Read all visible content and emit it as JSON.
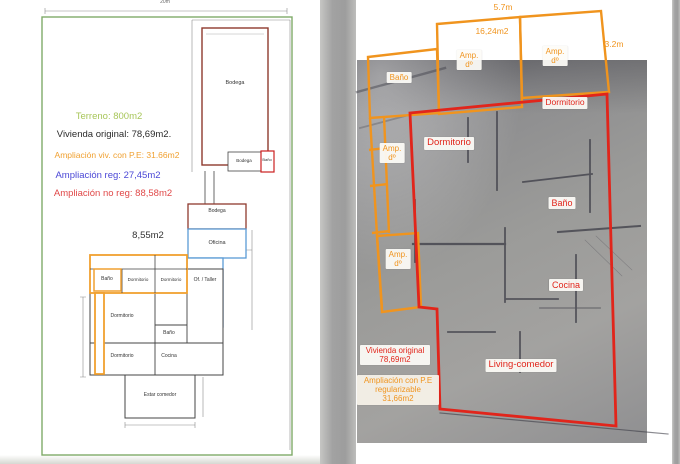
{
  "document": {
    "left_page": {
      "top_dimension": "20m",
      "legend": {
        "terreno": "Terreno: 800m2",
        "vivienda_original": "Vivienda original: 78,69m2.",
        "ampliacion_pe": "Ampliación viv. con P.E: 31.66m2",
        "ampliacion_reg": "Ampliación reg: 27,45m2",
        "ampliacion_no_reg": "Ampliación no reg: 88,58m2"
      },
      "area_note": "8,55m2",
      "rooms": {
        "bodega_big": "Bodega",
        "bodega_small": "Bodega",
        "bano_small": "Baño",
        "bodega_mid": "Bodega",
        "oficina": "Oficina",
        "of_taller": "Of. / Taller",
        "bano_top": "Baño",
        "dormitorio_top_1": "Dormitorio",
        "dormitorio_top_2": "Dormitorio",
        "dormitorio_mid": "Dormitorio",
        "dormitorio_bottom": "Dormitorio",
        "bano_right": "Baño",
        "cocina": "Cocina",
        "estar_comedor": "Estar comedor"
      }
    },
    "right_page": {
      "dimensions": {
        "top_width": "5.7m",
        "area": "16,24m2",
        "right_side": "3.2m"
      },
      "orange_labels": {
        "bano": "Baño",
        "amp_d": "Amp.\ndº"
      },
      "red_labels": {
        "dormitorio_top": "Dormitorio",
        "dormitorio_left": "Dormitorio",
        "bano": "Baño",
        "cocina": "Cocina",
        "living_comedor": "Living-comedor"
      },
      "summary": {
        "vivienda": "Vivienda original\n78,69m2",
        "ampliacion": "Ampliación con P.E\nregularizable\n31,66m2"
      }
    },
    "colors": {
      "site_green": "#7fab69",
      "annotation_orange": "#f0941e",
      "annotation_red": "#e1251b",
      "room_blue": "#5b9bd5",
      "bodega_dark_red": "#8f3a2e",
      "legend_green": "#a8c65a",
      "legend_orange": "#f0a030",
      "legend_blue": "#4b48d6",
      "legend_red": "#e04848"
    }
  }
}
